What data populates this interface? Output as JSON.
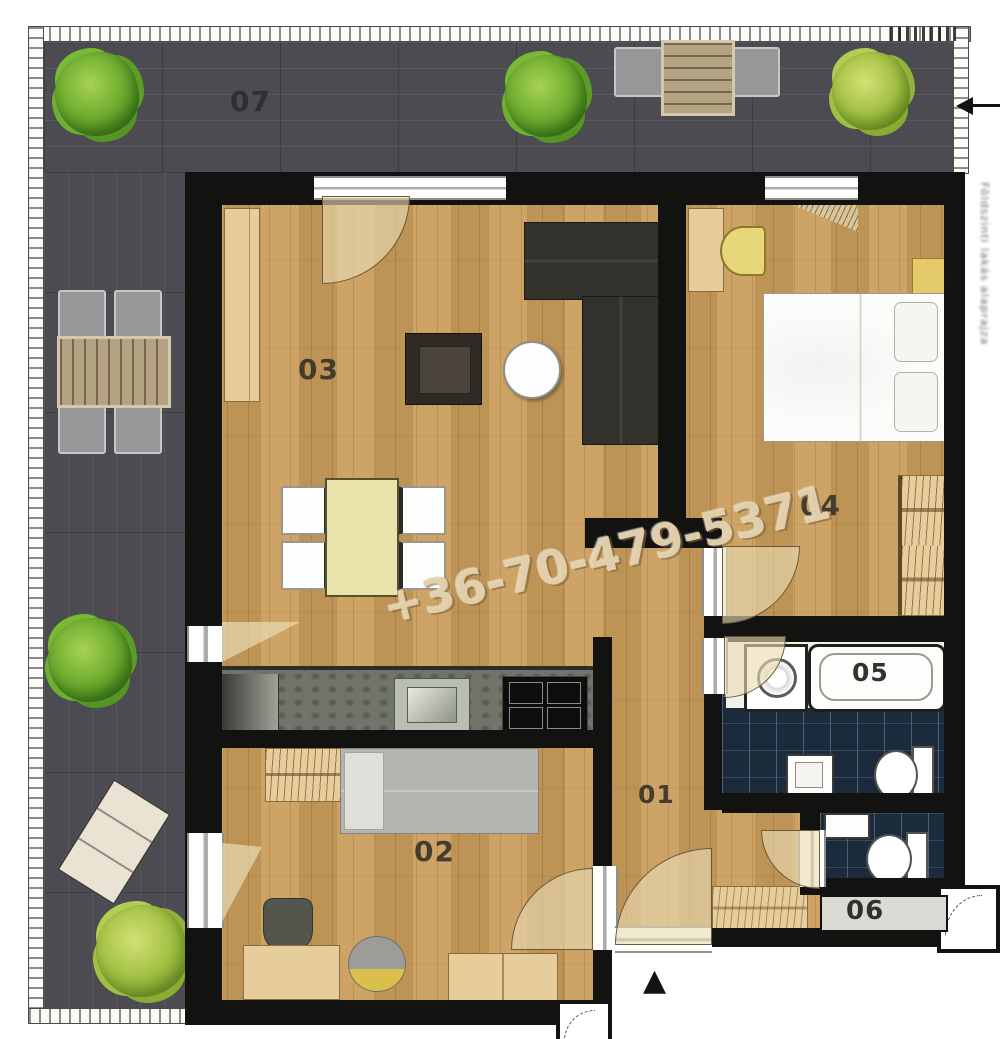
{
  "plan_title": "apartment floor plan",
  "rooms": {
    "terrace": {
      "label": "07"
    },
    "living": {
      "label": "03"
    },
    "bedroom_main": {
      "label": "04"
    },
    "bedroom_second": {
      "label": "02"
    },
    "hall": {
      "label": "01"
    },
    "bathroom": {
      "label": "05"
    },
    "wc": {
      "label": "06"
    }
  },
  "watermark": {
    "phone": "+36-70-479-5371"
  },
  "side_note": {
    "vertical_text": "Földszinti lakás alaprajza"
  },
  "symbols": {
    "entry_arrow": "▲"
  },
  "colors": {
    "deck": "#4b4b51",
    "wood_floor": "#c99d5a",
    "bath_tile": "#1c2b3b",
    "wall": "#121210",
    "watermark_text": "#e4d2af",
    "tree_green": "#6faa33"
  }
}
